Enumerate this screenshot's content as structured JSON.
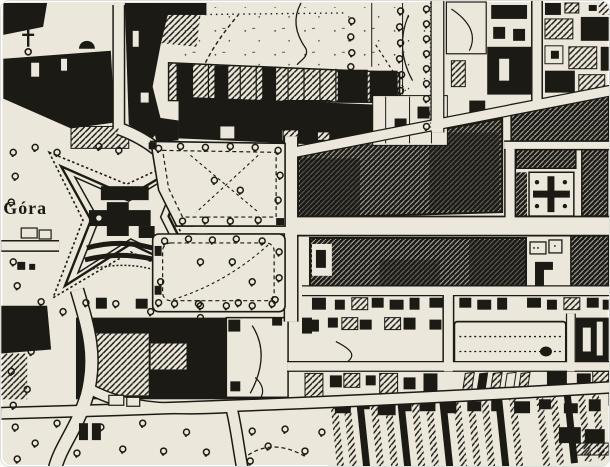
{
  "map": {
    "label": "Góra",
    "theme": {
      "paper": "#ebe7da",
      "ink": "#1c1a15",
      "page": "#fafaf8",
      "frame": "#ffffff",
      "shadow_edge": "#dcdcd8"
    }
  }
}
